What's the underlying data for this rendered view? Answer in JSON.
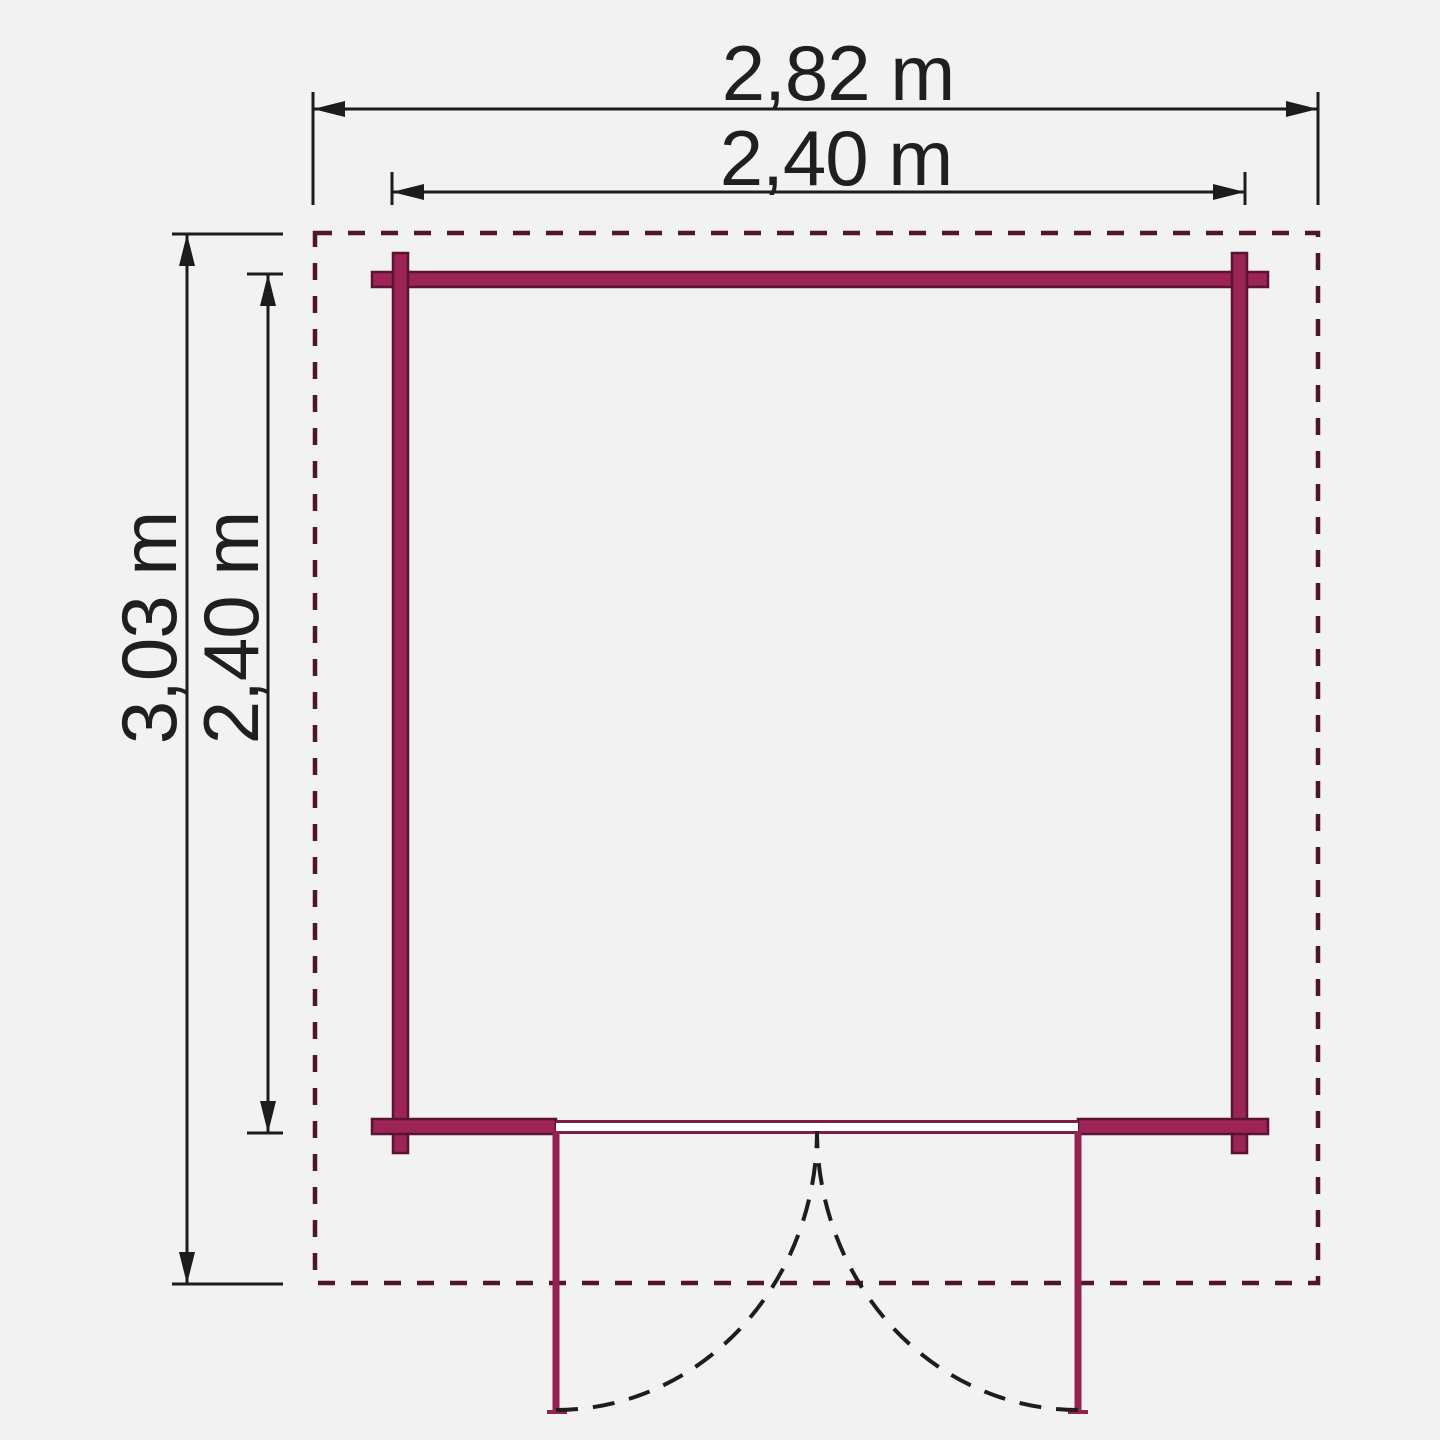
{
  "diagram": {
    "type": "floor-plan",
    "description": "Top-down floor plan of a square garden building (log cabin) with double doors at the front, dashed roof outline and dimension arrows",
    "dimensions": {
      "roof_width": "2,82 m",
      "wall_width": "2,40 m",
      "roof_depth": "3,03 m",
      "wall_depth": "2,40 m"
    },
    "colors": {
      "background": "#f2f2f2",
      "wall_fill": "#9c2457",
      "wall_outline": "#5a1331",
      "roof_outline_dashed": "#4f142e",
      "door_leaf": "#93224f",
      "threshold_edge": "#7e1d43",
      "threshold_fill": "#ffffff",
      "dimension_lines": "#1c1c1c",
      "door_swing_dashed": "#1d1d1d",
      "text": "#1f1f1f"
    }
  }
}
